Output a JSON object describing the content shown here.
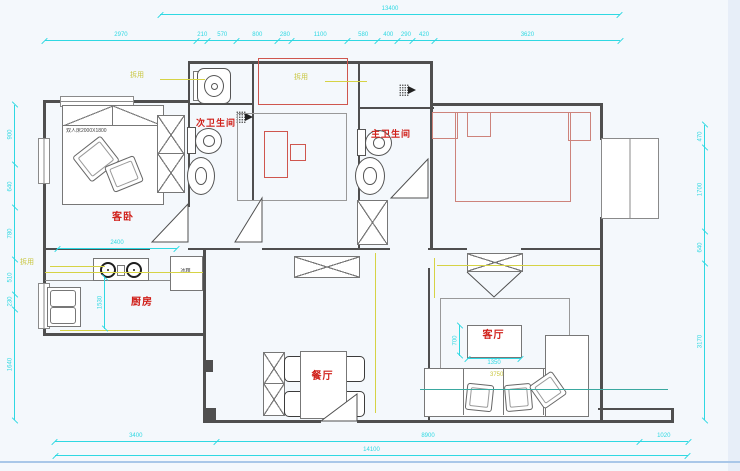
{
  "rooms": {
    "guest_bedroom": "客卧",
    "kitchen": "厨房",
    "dining": "餐厅",
    "living": "客厅",
    "second_bathroom": "次卫生间",
    "master_bathroom": "主卫生间"
  },
  "annotations": {
    "leader_label": "拆用",
    "bed_text": "双人床2000X1800",
    "fridge_text": "冰箱"
  },
  "dimensions": {
    "top_total": "13400",
    "top_segments": [
      "2970",
      "210",
      "570",
      "800",
      "280",
      "1100",
      "580",
      "400",
      "290",
      "420",
      "3620"
    ],
    "left_segments": [
      "900",
      "640",
      "780",
      "510",
      "230",
      "1640"
    ],
    "right_segments": [
      "470",
      "1700",
      "640",
      "3170"
    ],
    "bottom_segments": [
      "3400",
      "8900",
      "1020"
    ],
    "bottom_total": "14100",
    "kitchen_width": "2400",
    "kitchen_depth": "1530",
    "coffee_table_width": "1350",
    "coffee_table_depth": "700",
    "sofa_width": "3750"
  },
  "colors": {
    "dimension": "#2fd8e2",
    "room_label": "#d0201a",
    "new_furniture": "#cf564e",
    "existing_bed_red": "#cd837b",
    "leader": "#d6d345",
    "wall": "#4f4f4f"
  }
}
